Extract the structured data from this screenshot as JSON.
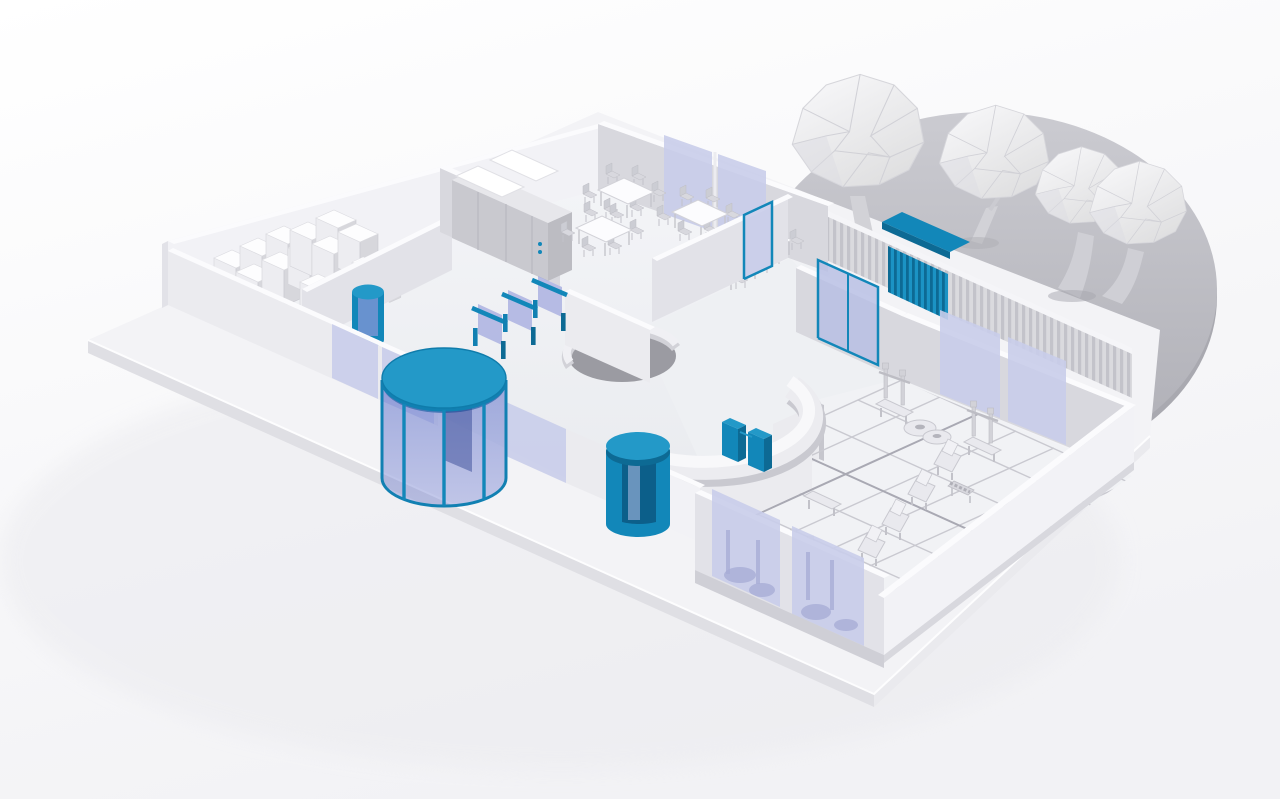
{
  "meta": {
    "title": "Isometric 3D building floor-plan render",
    "style": "low-poly clay render, white architecture with blue security accents",
    "visible_text": "none"
  },
  "palette": {
    "background": "#ffffff",
    "ground_shadow": "#e9e9ee",
    "platform_top": "#f3f3f6",
    "platform_side": "#e0e0e5",
    "plaza_gray": "#c2c2c8",
    "plaza_rim": "#a9a9b0",
    "wall_light": "#ebebef",
    "wall_shaded": "#d8d8de",
    "floor_gray": "#eef0f3",
    "glass_lavender": "#c9cdea",
    "glass_violet": "#7d8bd4",
    "accent_blue": "#1287b9",
    "accent_blue_light": "#2399c8",
    "accent_blue_dark": "#0d6a94",
    "tree_fill": "#f1f1f4",
    "tree_shade": "#dcdce2",
    "trunk_gray": "#d2d2d7"
  },
  "scene": {
    "site": {
      "platform": "raised rectangular base slab",
      "plaza": "gray circular terrace behind building",
      "trees": {
        "count": 4,
        "style": "low-poly faceted canopies"
      }
    },
    "rooms": [
      {
        "name": "storage-room",
        "features": [
          "stacked white archive boxes",
          "blue access portal"
        ]
      },
      {
        "name": "cafeteria",
        "features": [
          "5 tables with chairs",
          "serving counter with white bins",
          "2 lavender windows"
        ]
      },
      {
        "name": "entrance-lobby",
        "features": [
          "glass facade",
          "large blue revolving door",
          "3 blue speed gates",
          "curved reception desk",
          "circular partition",
          "small blue security portal",
          "2 blue pedestal gates"
        ]
      },
      {
        "name": "gym-lobby",
        "features": [
          "blue framed door",
          "blue framed sliding glass door"
        ]
      },
      {
        "name": "gym",
        "features": [
          "tiled floor",
          "2 squat racks",
          "weight plates",
          "flat and incline benches",
          "dumbbell rack",
          "2 rear windows",
          "2 front glass walls"
        ]
      }
    ],
    "exterior": {
      "fence": "ribbed perimeter wall along right side",
      "canopy_gate": "blue canopy with hanging blue slats on fence"
    },
    "counts": {
      "trees": 4,
      "cafeteria_tables": 5,
      "speed_gates": 3,
      "pedestal_gates": 2,
      "revolving_doors": 2,
      "portals": 2
    }
  }
}
